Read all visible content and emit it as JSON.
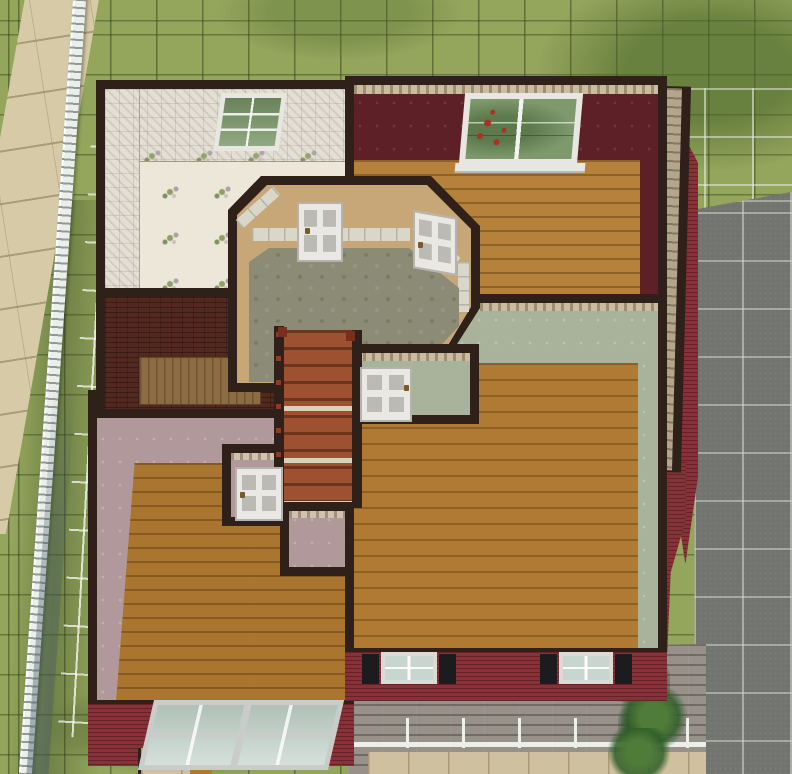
{
  "scene": {
    "description": "Top-down second-floor build/buy view of a suburban house in a life-simulation game",
    "grid_visible": true,
    "ui_text": []
  },
  "colors": {
    "grass": "#94a55c",
    "grass_dark": "#7d9551",
    "sidewalk": "#d6cba6",
    "fence_white": "#eceeea",
    "driveway": "#71746f",
    "wall_dark": "#2f2119",
    "tile_wall": "#e3dfd4",
    "tile_floor": "#ece7d9",
    "maroon_wall": "#5d2026",
    "border_tan": "#c9bca0",
    "hall_tan": "#c7a678",
    "wainscot": "#d9d6ca",
    "carpet": "#8c8b76",
    "wood_orange": "#b5813b",
    "wood_mid": "#b07a33",
    "wood_pink_room": "#a9752f",
    "brick": "#53291f",
    "platform_wood": "#8d6b43",
    "pink_wall": "#b1989b",
    "pink_border": "#cfc3b0",
    "sage_wall": "#a9b29b",
    "red_siding": "#8a3038",
    "stairs_wood": "#9d5130",
    "stair_rail_red": "#7c2e1c",
    "step_light": "#d8d1bd",
    "ext_stair_wood": "#b3a68c",
    "deck_wood": "#97918a",
    "tan_tile": "#cfc0a0",
    "door_white": "#e9e8e4",
    "window_frame": "#e8e6e0",
    "glass_pale": "#c8d6d0",
    "glass_green": "#7e9a6d",
    "rose_red": "#a83226",
    "shutter_black": "#1c1c1e",
    "plant_green": "#44702f"
  },
  "environment": {
    "lawn": "grass lot with dark terrain grid",
    "sidewalk": "beige tiled sidewalk, upper left",
    "fence": "white picket fence along left lot edge",
    "driveway": "gray paved driveway with white lot grid, right side",
    "shrub_count": 3
  },
  "house": {
    "exterior": "dark red horizontal siding",
    "rooms": [
      {
        "name": "bathroom",
        "walls": "white tile with floral accents",
        "floor": "white tile",
        "windows": 1
      },
      {
        "name": "bedroom-north",
        "walls": "dark maroon with tan border",
        "floor": "orange wood planks",
        "windows": 1
      },
      {
        "name": "hallway",
        "walls": "tan with white wainscot",
        "floor": "sage patterned carpet",
        "doors": 2
      },
      {
        "name": "utility-nook",
        "walls": "brick",
        "floor": "brick with wood platform"
      },
      {
        "name": "bedroom-southwest",
        "walls": "dusty pink with floral border",
        "floor": "wood planks",
        "windows": 1,
        "doors": 1
      },
      {
        "name": "living-room",
        "walls": "sage green with patterned border",
        "floor": "wood planks",
        "windows": 2,
        "doors": 1
      }
    ],
    "stairs_interior": "red-brown wooden staircase with red railing, leading down",
    "stairs_exterior": "weathered wooden side steps, east side",
    "deck": "weathered gray plank deck with white railing, lower right"
  }
}
